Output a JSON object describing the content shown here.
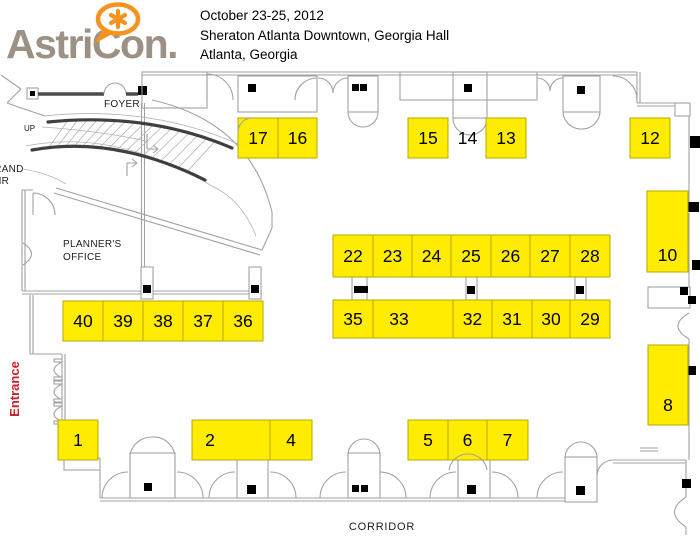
{
  "header": {
    "logo": {
      "text": "AstriCon.",
      "asterisk_icon": "asterisk-speech-bubble",
      "text_color": "#9c9185",
      "accent_color": "#f6921e"
    },
    "event": {
      "dates": "October 23-25, 2012",
      "venue": "Sheraton Atlanta Downtown, Georgia Hall",
      "city": "Atlanta, Georgia"
    }
  },
  "floorplan": {
    "labels": {
      "foyer": "FOYER",
      "up": "UP",
      "grand_stair_line1": "GRAND",
      "grand_stair_line2": "STAIR",
      "planners_line1": "PLANNER'S",
      "planners_line2": "OFFICE",
      "entrance": "Entrance",
      "corridor": "CORRIDOR"
    },
    "colors": {
      "booth_fill": "#ffec00",
      "booth_border": "#b5a900",
      "wall_gray": "#a2a2a2",
      "entrance_red": "#cb2027"
    },
    "booths": [
      {
        "label": "17",
        "x": 238,
        "y": 118,
        "w": 40,
        "h": 40,
        "highlighted": true
      },
      {
        "label": "16",
        "x": 278,
        "y": 118,
        "w": 39,
        "h": 40,
        "highlighted": true
      },
      {
        "label": "15",
        "x": 408,
        "y": 118,
        "w": 40,
        "h": 40,
        "highlighted": true
      },
      {
        "label": "14",
        "x": 449,
        "y": 118,
        "w": 37,
        "h": 40,
        "highlighted": false
      },
      {
        "label": "13",
        "x": 486,
        "y": 118,
        "w": 40,
        "h": 40,
        "highlighted": true
      },
      {
        "label": "12",
        "x": 630,
        "y": 118,
        "w": 40,
        "h": 40,
        "highlighted": true
      },
      {
        "label": "10",
        "x": 647,
        "y": 191,
        "w": 41,
        "h": 81,
        "highlighted": true,
        "ly": 255
      },
      {
        "label": "8",
        "x": 648,
        "y": 345,
        "w": 40,
        "h": 80,
        "highlighted": true,
        "ly": 405
      },
      {
        "label": "22",
        "x": 333,
        "y": 235,
        "w": 40,
        "h": 42,
        "highlighted": true
      },
      {
        "label": "23",
        "x": 373,
        "y": 235,
        "w": 39,
        "h": 42,
        "highlighted": true
      },
      {
        "label": "24",
        "x": 412,
        "y": 235,
        "w": 39,
        "h": 42,
        "highlighted": true
      },
      {
        "label": "25",
        "x": 451,
        "y": 235,
        "w": 40,
        "h": 42,
        "highlighted": true
      },
      {
        "label": "26",
        "x": 491,
        "y": 235,
        "w": 39,
        "h": 42,
        "highlighted": true
      },
      {
        "label": "27",
        "x": 530,
        "y": 235,
        "w": 40,
        "h": 42,
        "highlighted": true
      },
      {
        "label": "28",
        "x": 570,
        "y": 235,
        "w": 40,
        "h": 42,
        "highlighted": true
      },
      {
        "label": "35",
        "x": 333,
        "y": 300,
        "w": 40,
        "h": 38,
        "highlighted": true
      },
      {
        "label": "33",
        "x": 373,
        "y": 300,
        "w": 80,
        "h": 38,
        "highlighted": true,
        "lx": 399
      },
      {
        "label": "32",
        "x": 453,
        "y": 300,
        "w": 39,
        "h": 38,
        "highlighted": true
      },
      {
        "label": "31",
        "x": 492,
        "y": 300,
        "w": 40,
        "h": 38,
        "highlighted": true
      },
      {
        "label": "30",
        "x": 532,
        "y": 300,
        "w": 38,
        "h": 38,
        "highlighted": true
      },
      {
        "label": "29",
        "x": 570,
        "y": 300,
        "w": 40,
        "h": 38,
        "highlighted": true
      },
      {
        "label": "40",
        "x": 63,
        "y": 301,
        "w": 40,
        "h": 40,
        "highlighted": true
      },
      {
        "label": "39",
        "x": 103,
        "y": 301,
        "w": 40,
        "h": 40,
        "highlighted": true
      },
      {
        "label": "38",
        "x": 143,
        "y": 301,
        "w": 40,
        "h": 40,
        "highlighted": true
      },
      {
        "label": "37",
        "x": 183,
        "y": 301,
        "w": 40,
        "h": 40,
        "highlighted": true
      },
      {
        "label": "36",
        "x": 223,
        "y": 301,
        "w": 40,
        "h": 40,
        "highlighted": true
      },
      {
        "label": "1",
        "x": 58,
        "y": 420,
        "w": 40,
        "h": 40,
        "highlighted": true
      },
      {
        "label": "2",
        "x": 192,
        "y": 420,
        "w": 78,
        "h": 40,
        "highlighted": true,
        "lx": 210
      },
      {
        "label": "4",
        "x": 270,
        "y": 420,
        "w": 42,
        "h": 40,
        "highlighted": true
      },
      {
        "label": "5",
        "x": 408,
        "y": 420,
        "w": 40,
        "h": 40,
        "highlighted": true
      },
      {
        "label": "6",
        "x": 448,
        "y": 420,
        "w": 39,
        "h": 40,
        "highlighted": true
      },
      {
        "label": "7",
        "x": 487,
        "y": 420,
        "w": 41,
        "h": 40,
        "highlighted": true
      }
    ]
  }
}
